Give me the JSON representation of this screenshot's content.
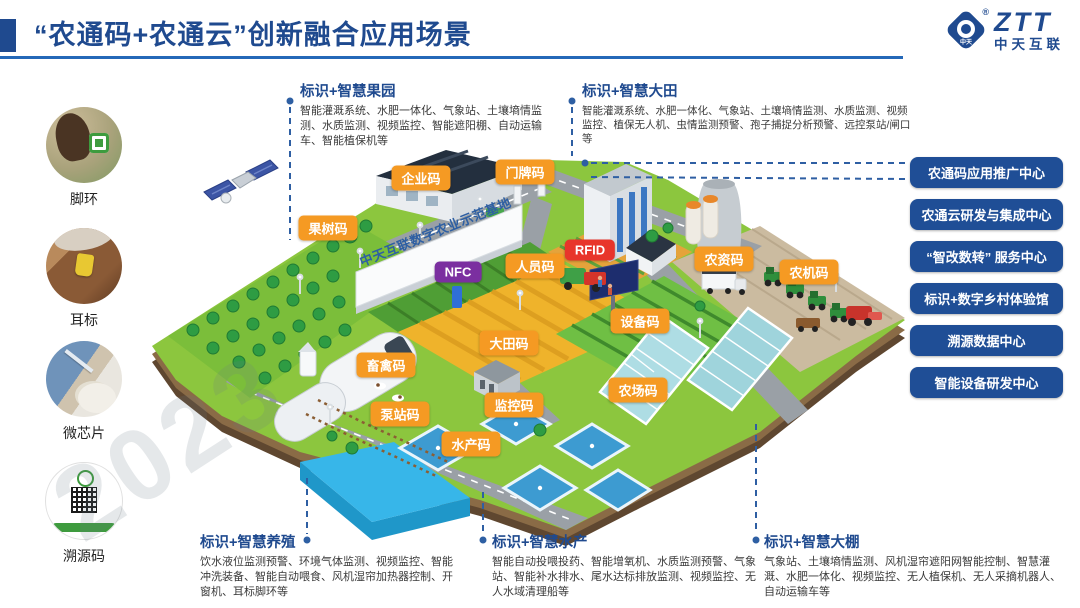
{
  "colors": {
    "primary_blue": "#1F4A8F",
    "rule_blue": "#2468B8",
    "tag_orange": "#F59A23",
    "tag_red": "#E8352B",
    "tag_purple": "#7B2FA0",
    "button_blue": "#1F4E96"
  },
  "header": {
    "title": "“农通码+农通云”创新融合应用场景",
    "logo_brand": "ZTT",
    "logo_sub": "中天互联",
    "logo_mark_text": "中天",
    "logo_reg": "®"
  },
  "sidebar": {
    "items": [
      {
        "label": "脚环",
        "photo": "legring",
        "y": 107
      },
      {
        "label": "耳标",
        "photo": "eartag",
        "y": 228
      },
      {
        "label": "微芯片",
        "photo": "chip",
        "y": 341
      },
      {
        "label": "溯源码",
        "photo": "qr",
        "y": 462
      }
    ]
  },
  "sections": {
    "orchard": {
      "title": "标识+智慧果园",
      "desc": "智能灌溉系统、水肥一体化、气象站、土壤墒情监测、水质监测、视频监控、智能遮阳棚、自动运输车、智能植保机等"
    },
    "field": {
      "title": "标识+智慧大田",
      "desc": "智能灌溉系统、水肥一体化、气象站、土壤墒情监测、水质监测、视频监控、植保无人机、虫情监测预警、孢子捕捉分析预警、远控泵站/闸口等"
    },
    "breeding": {
      "title": "标识+智慧养殖",
      "desc": "饮水液位监测预警、环境气体监测、视频监控、智能冲洗装备、智能自动喂食、风机湿帘加热器控制、开窗机、耳标脚环等"
    },
    "aquaculture": {
      "title": "标识+智慧水产",
      "desc": "智能自动投喂投药、智能增氧机、水质监测预警、气象站、智能补水排水、尾水达标排放监测、视频监控、无人水域清理船等"
    },
    "greenhouse": {
      "title": "标识+智慧大棚",
      "desc": "气象站、土壤墒情监测、风机湿帘遮阳网智能控制、智慧灌溉、水肥一体化、视频监控、无人植保机、无人采摘机器人、自动运输车等"
    }
  },
  "map": {
    "base_name": "中天互联数字农业示范基地",
    "watermark": "2023",
    "tags": [
      {
        "label": "企业码",
        "x": 421,
        "y": 178,
        "color": "#F59A23"
      },
      {
        "label": "门牌码",
        "x": 525,
        "y": 172,
        "color": "#F59A23"
      },
      {
        "label": "果树码",
        "x": 328,
        "y": 228,
        "color": "#F59A23"
      },
      {
        "label": "NFC",
        "x": 458,
        "y": 272,
        "color": "#7B2FA0"
      },
      {
        "label": "人员码",
        "x": 535,
        "y": 266,
        "color": "#F59A23"
      },
      {
        "label": "RFID",
        "x": 590,
        "y": 250,
        "color": "#E8352B"
      },
      {
        "label": "农资码",
        "x": 724,
        "y": 259,
        "color": "#F59A23"
      },
      {
        "label": "农机码",
        "x": 809,
        "y": 272,
        "color": "#F59A23"
      },
      {
        "label": "设备码",
        "x": 640,
        "y": 321,
        "color": "#F59A23"
      },
      {
        "label": "大田码",
        "x": 509,
        "y": 343,
        "color": "#F59A23"
      },
      {
        "label": "畜禽码",
        "x": 386,
        "y": 365,
        "color": "#F59A23"
      },
      {
        "label": "农场码",
        "x": 638,
        "y": 390,
        "color": "#F59A23"
      },
      {
        "label": "泵站码",
        "x": 400,
        "y": 414,
        "color": "#F59A23"
      },
      {
        "label": "监控码",
        "x": 514,
        "y": 405,
        "color": "#F59A23"
      },
      {
        "label": "水产码",
        "x": 471,
        "y": 444,
        "color": "#F59A23"
      }
    ]
  },
  "right_panel": {
    "buttons": [
      {
        "label": "农通码应用推广中心",
        "y": 157
      },
      {
        "label": "农通云研发与集成中心",
        "y": 199
      },
      {
        "label": "“智改数转” 服务中心",
        "y": 241
      },
      {
        "label": "标识+数字乡村体验馆",
        "y": 283
      },
      {
        "label": "溯源数据中心",
        "y": 325
      },
      {
        "label": "智能设备研发中心",
        "y": 367
      }
    ]
  }
}
